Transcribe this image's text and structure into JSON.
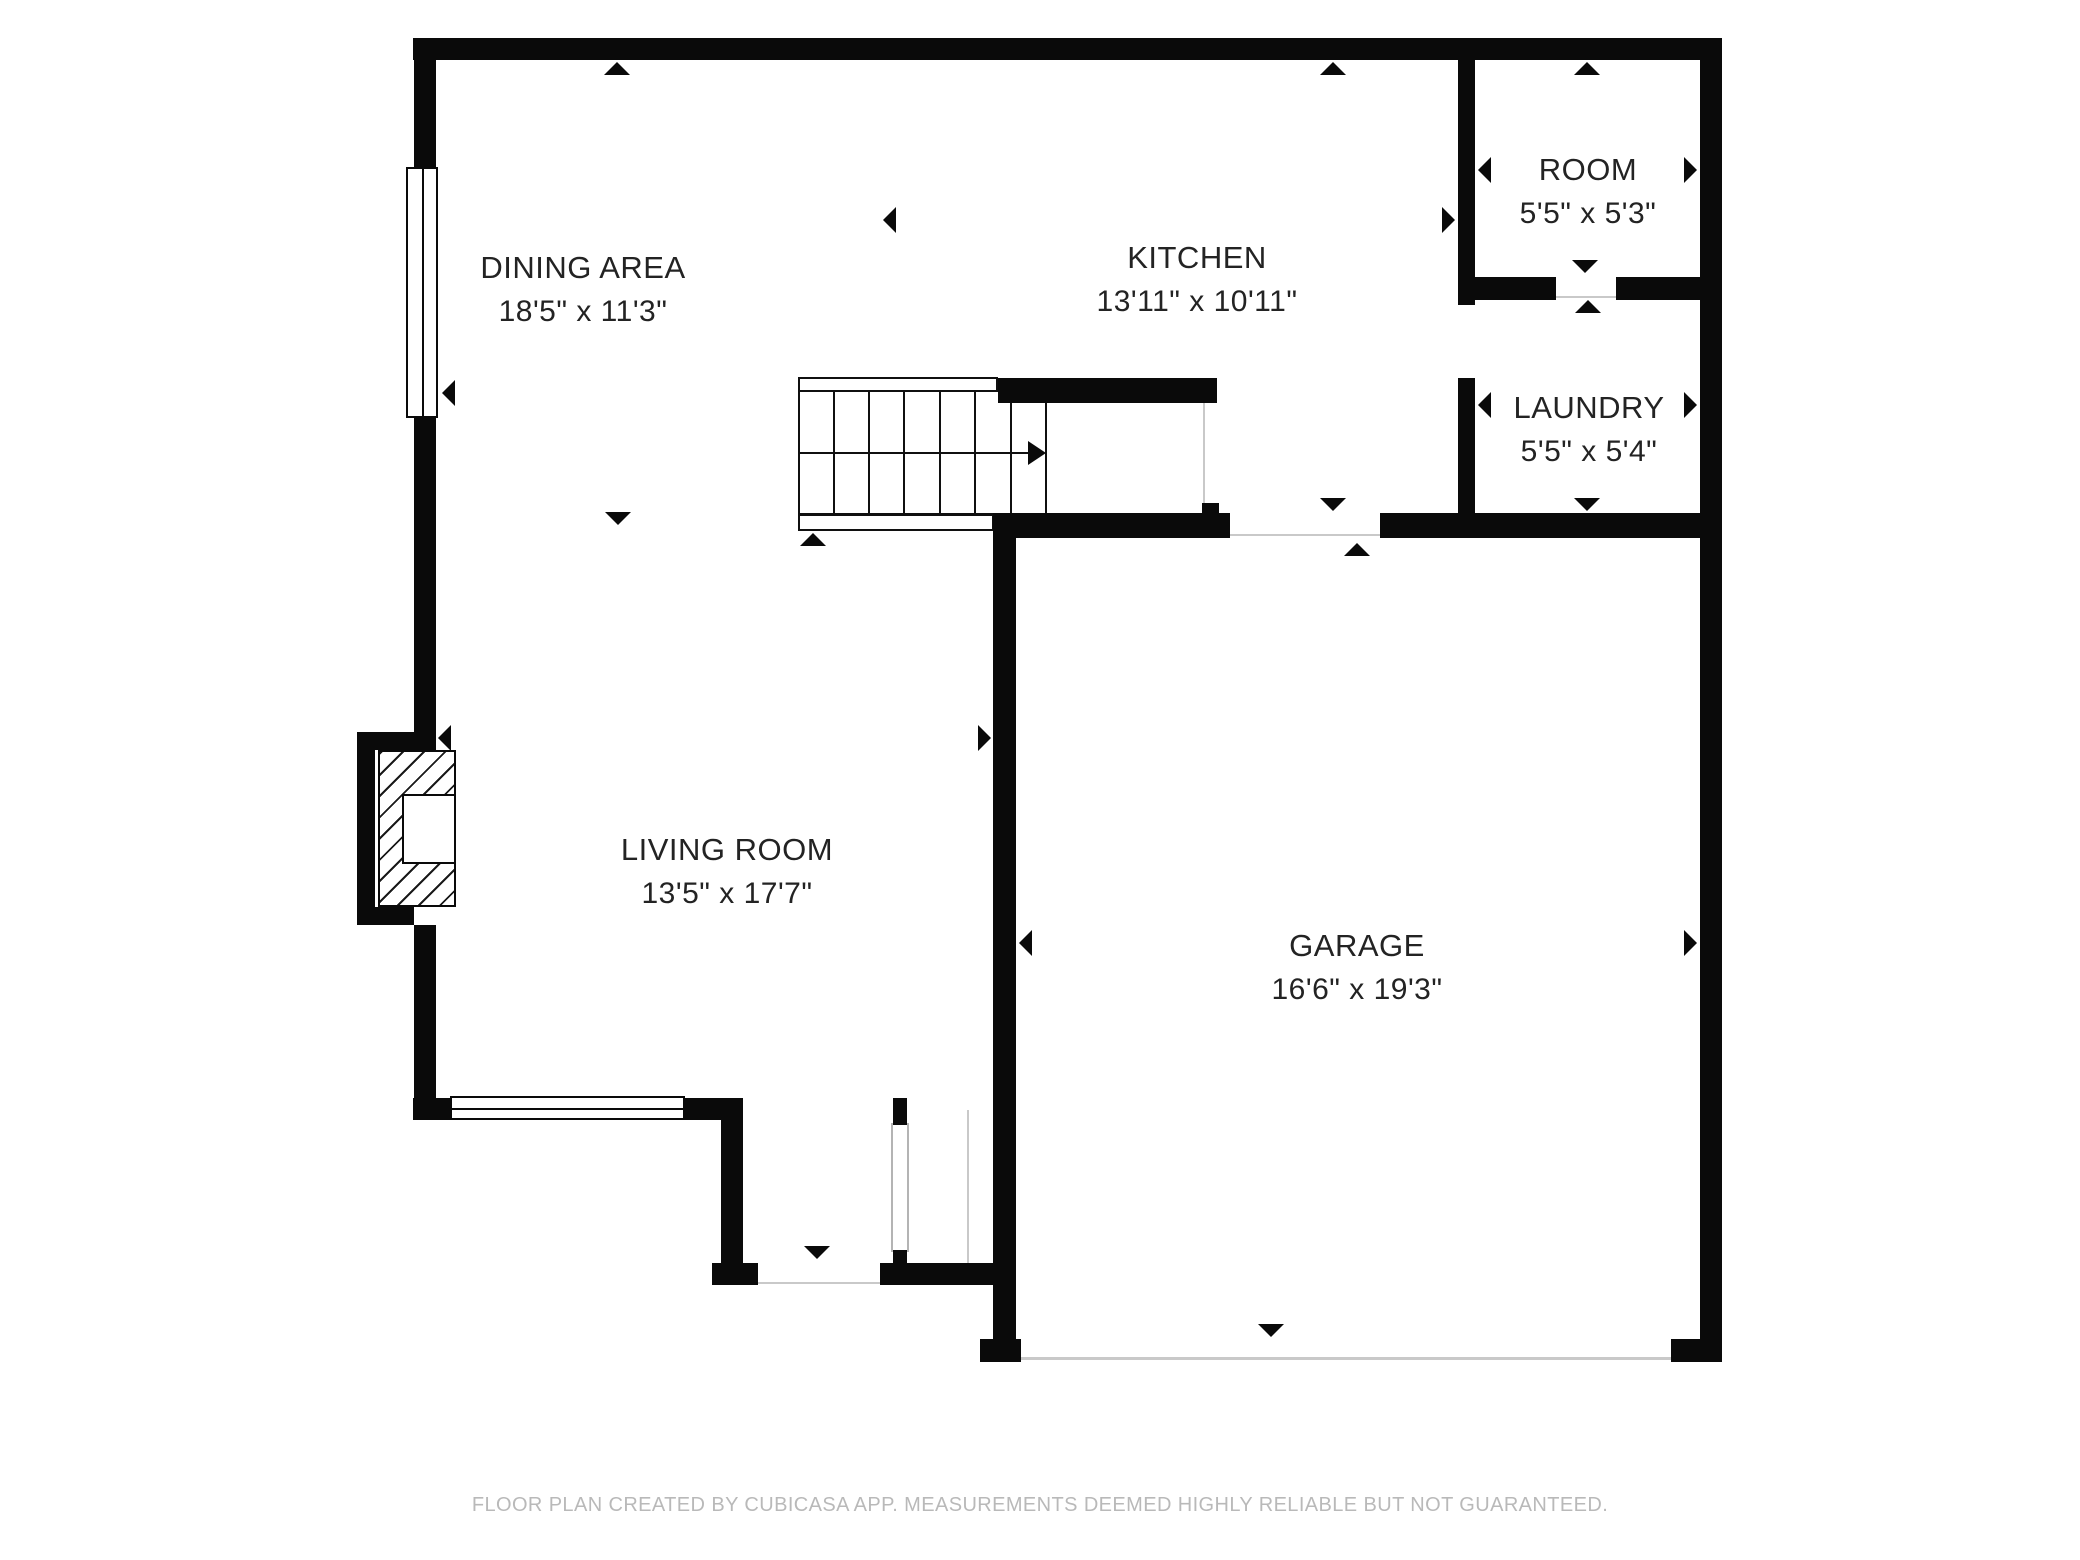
{
  "canvas": {
    "width": 2080,
    "height": 1560,
    "background": "#ffffff",
    "wall_color": "#0a0a0a",
    "thin_line_color": "#c9c9c9"
  },
  "rooms": [
    {
      "id": "dining-area",
      "name": "DINING AREA",
      "dims": "18'5\" x 11'3\"",
      "cx": 583,
      "cy": 268
    },
    {
      "id": "kitchen",
      "name": "KITCHEN",
      "dims": "13'11\" x 10'11\"",
      "cx": 1197,
      "cy": 258
    },
    {
      "id": "room",
      "name": "ROOM",
      "dims": "5'5\" x 5'3\"",
      "cx": 1588,
      "cy": 170
    },
    {
      "id": "laundry",
      "name": "LAUNDRY",
      "dims": "5'5\" x 5'4\"",
      "cx": 1589,
      "cy": 408
    },
    {
      "id": "living-room",
      "name": "LIVING ROOM",
      "dims": "13'5\" x 17'7\"",
      "cx": 727,
      "cy": 850
    },
    {
      "id": "garage",
      "name": "GARAGE",
      "dims": "16'6\" x 19'3\"",
      "cx": 1357,
      "cy": 946
    }
  ],
  "footer": {
    "text": "FLOOR PLAN CREATED BY CUBICASA APP. MEASUREMENTS DEEMED HIGHLY RELIABLE BUT NOT GUARANTEED."
  },
  "plan": {
    "walls": [
      {
        "x": 413,
        "y": 38,
        "w": 1309,
        "h": 22
      },
      {
        "x": 414,
        "y": 60,
        "w": 22,
        "h": 107
      },
      {
        "x": 414,
        "y": 418,
        "w": 22,
        "h": 332
      },
      {
        "x": 414,
        "y": 925,
        "w": 22,
        "h": 173
      },
      {
        "x": 413,
        "y": 1098,
        "w": 39,
        "h": 22
      },
      {
        "x": 685,
        "y": 1098,
        "w": 58,
        "h": 22
      },
      {
        "x": 721,
        "y": 1118,
        "w": 22,
        "h": 147
      },
      {
        "x": 712,
        "y": 1263,
        "w": 46,
        "h": 22
      },
      {
        "x": 880,
        "y": 1263,
        "w": 136,
        "h": 22
      },
      {
        "x": 893,
        "y": 1098,
        "w": 14,
        "h": 27
      },
      {
        "x": 893,
        "y": 1250,
        "w": 14,
        "h": 35
      },
      {
        "x": 993,
        "y": 537,
        "w": 23,
        "h": 825
      },
      {
        "x": 980,
        "y": 1339,
        "w": 41,
        "h": 23
      },
      {
        "x": 1671,
        "y": 1339,
        "w": 51,
        "h": 23
      },
      {
        "x": 1700,
        "y": 38,
        "w": 22,
        "h": 1324
      },
      {
        "x": 998,
        "y": 378,
        "w": 219,
        "h": 25
      },
      {
        "x": 993,
        "y": 513,
        "w": 237,
        "h": 25
      },
      {
        "x": 1380,
        "y": 513,
        "w": 320,
        "h": 25
      },
      {
        "x": 1458,
        "y": 493,
        "w": 17,
        "h": 20
      },
      {
        "x": 1458,
        "y": 60,
        "w": 17,
        "h": 245
      },
      {
        "x": 1458,
        "y": 378,
        "w": 17,
        "h": 135
      },
      {
        "x": 1475,
        "y": 277,
        "w": 81,
        "h": 23
      },
      {
        "x": 1616,
        "y": 277,
        "w": 84,
        "h": 23
      },
      {
        "x": 1202,
        "y": 503,
        "w": 17,
        "h": 12
      }
    ],
    "windows": [
      {
        "x": 406,
        "y": 167,
        "w": 32,
        "h": 251,
        "orient": "v",
        "thin": false
      },
      {
        "x": 450,
        "y": 1096,
        "w": 235,
        "h": 24,
        "orient": "h",
        "thin": false
      },
      {
        "x": 891,
        "y": 1123,
        "w": 18,
        "h": 129,
        "orient": "v",
        "thin": true
      }
    ],
    "thin_lines": [
      {
        "x": 1203,
        "y": 392,
        "w": 2,
        "h": 119
      },
      {
        "x": 1230,
        "y": 534,
        "w": 150,
        "h": 2
      },
      {
        "x": 757,
        "y": 1282,
        "w": 123,
        "h": 2
      },
      {
        "x": 1556,
        "y": 296,
        "w": 60,
        "h": 2
      },
      {
        "x": 1021,
        "y": 1357,
        "w": 650,
        "h": 3
      },
      {
        "x": 967,
        "y": 1110,
        "w": 2,
        "h": 153
      }
    ],
    "stairs": {
      "x": 798,
      "y": 390,
      "w": 249,
      "h": 125,
      "treads": [
        833,
        868,
        903,
        939,
        974,
        1010
      ],
      "mid_y": 452,
      "mid_x1": 798,
      "mid_x2": 1028,
      "arrow_tip_x": 1046,
      "top_rail": {
        "x": 798,
        "y": 377,
        "w": 200,
        "h": 15
      },
      "bottom_rail": {
        "x": 798,
        "y": 514,
        "w": 196,
        "h": 17
      }
    },
    "fireplace": {
      "bump": [
        {
          "x": 357,
          "y": 732,
          "w": 18,
          "h": 193
        },
        {
          "x": 357,
          "y": 732,
          "w": 57,
          "h": 18
        },
        {
          "x": 357,
          "y": 907,
          "w": 57,
          "h": 18
        }
      ],
      "hatch": {
        "x": 378,
        "y": 750,
        "w": 78,
        "h": 157
      },
      "inset": {
        "x": 402,
        "y": 794,
        "w": 54,
        "h": 70
      }
    },
    "markers": [
      {
        "dir": "up",
        "x": 617,
        "y": 62
      },
      {
        "dir": "up",
        "x": 1333,
        "y": 62
      },
      {
        "dir": "up",
        "x": 1587,
        "y": 62
      },
      {
        "dir": "left",
        "x": 883,
        "y": 220
      },
      {
        "dir": "right",
        "x": 1455,
        "y": 220
      },
      {
        "dir": "left",
        "x": 1478,
        "y": 170
      },
      {
        "dir": "right",
        "x": 1697,
        "y": 170
      },
      {
        "dir": "left",
        "x": 442,
        "y": 393
      },
      {
        "dir": "down",
        "x": 618,
        "y": 525
      },
      {
        "dir": "up",
        "x": 813,
        "y": 533
      },
      {
        "dir": "left",
        "x": 438,
        "y": 738
      },
      {
        "dir": "right",
        "x": 991,
        "y": 738
      },
      {
        "dir": "down",
        "x": 1585,
        "y": 273
      },
      {
        "dir": "up",
        "x": 1588,
        "y": 300
      },
      {
        "dir": "left",
        "x": 1478,
        "y": 405
      },
      {
        "dir": "right",
        "x": 1697,
        "y": 405
      },
      {
        "dir": "down",
        "x": 1587,
        "y": 511
      },
      {
        "dir": "down",
        "x": 1333,
        "y": 511
      },
      {
        "dir": "up",
        "x": 1357,
        "y": 543
      },
      {
        "dir": "left",
        "x": 1019,
        "y": 943
      },
      {
        "dir": "right",
        "x": 1697,
        "y": 943
      },
      {
        "dir": "down",
        "x": 817,
        "y": 1259
      },
      {
        "dir": "down",
        "x": 1271,
        "y": 1337
      }
    ]
  }
}
